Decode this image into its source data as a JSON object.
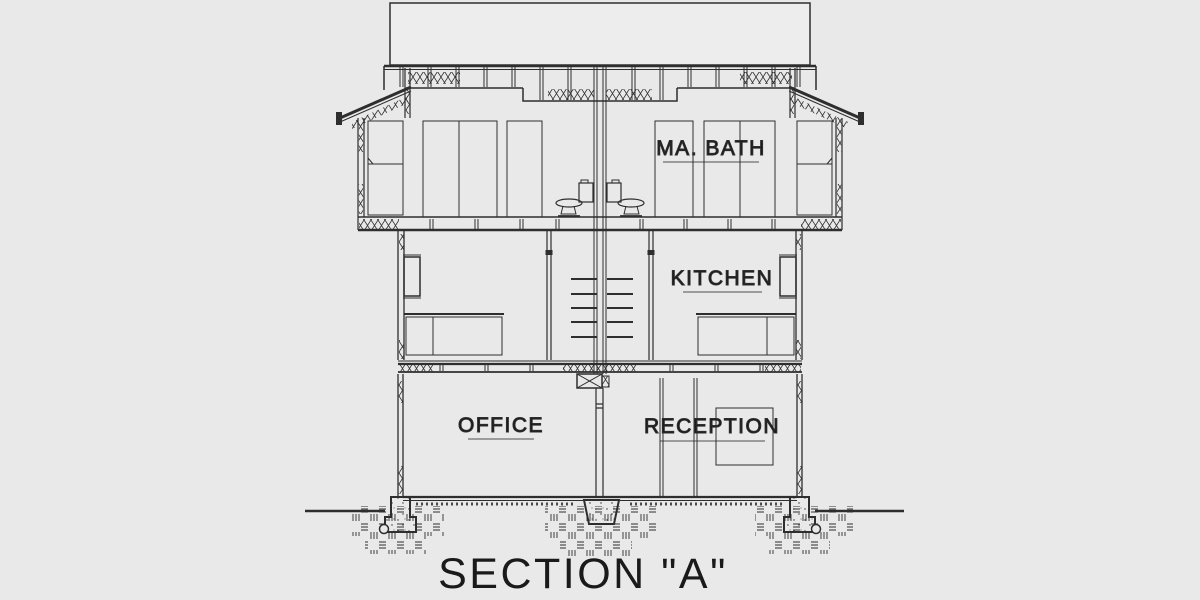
{
  "drawing": {
    "title": "SECTION \"A\"",
    "rooms": {
      "ma_bath": "MA. BATH",
      "kitchen": "KITCHEN",
      "office": "OFFICE",
      "reception": "RECEPTION"
    },
    "colors": {
      "background": "#e9e9e9",
      "paper": "#ededed",
      "line": "#2e2e2e",
      "text": "#1a1a1a"
    }
  }
}
